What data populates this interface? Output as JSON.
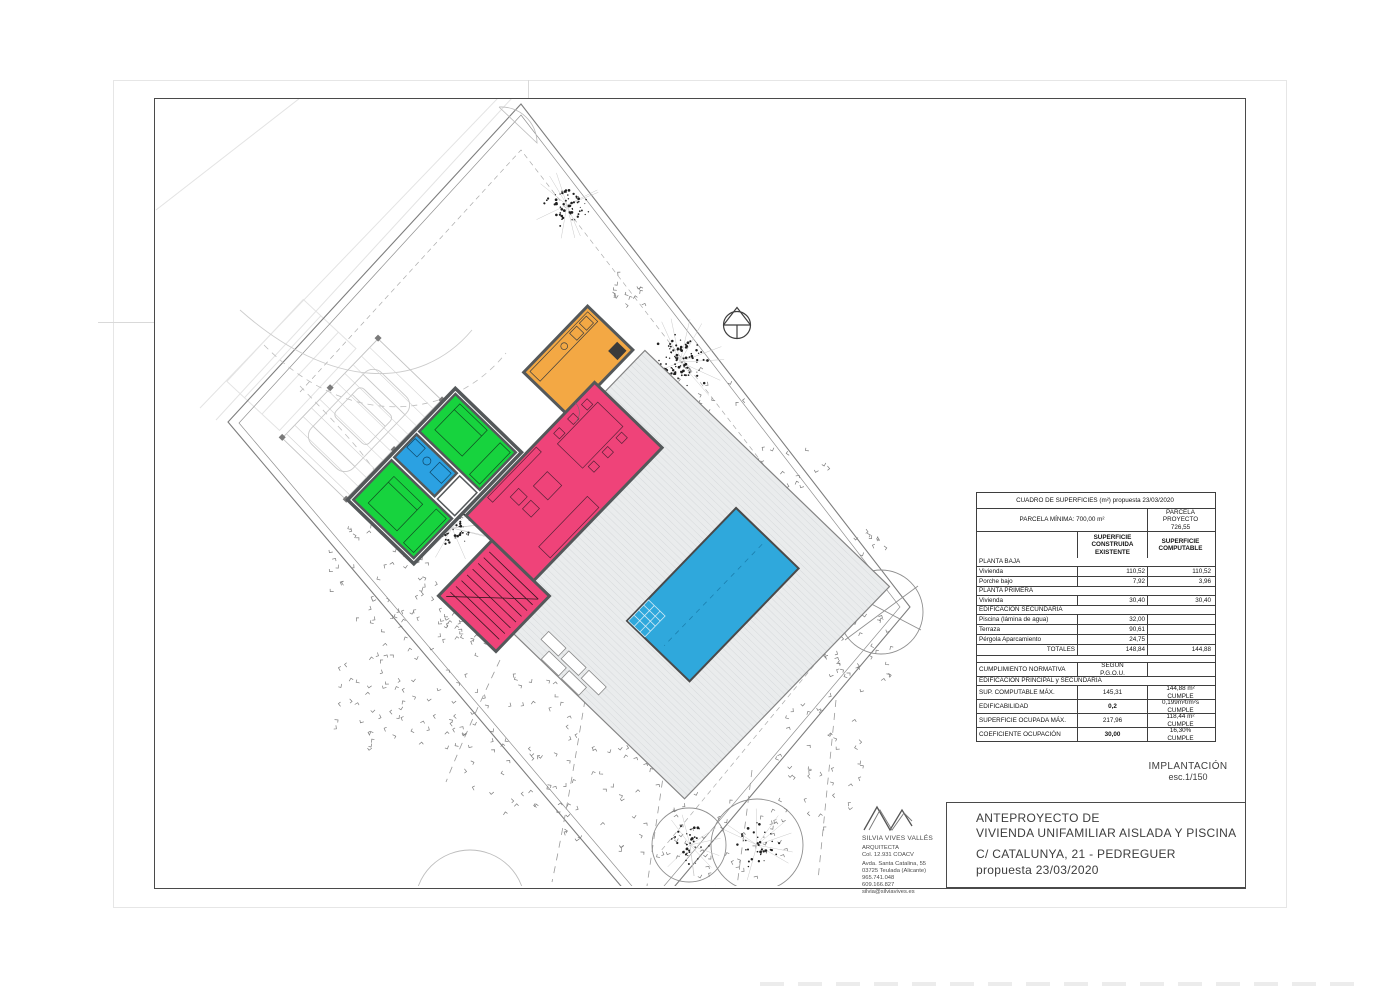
{
  "document": {
    "sheet_label": "IMPLANTACIÓN",
    "sheet_scale": "esc.1/150",
    "title_block": {
      "project_line1": "ANTEPROYECTO DE",
      "project_line2": "VIVIENDA UNIFAMILIAR AISLADA Y PISCINA",
      "address": "C/ CATALUNYA, 21  - PEDREGUER",
      "proposal": "propuesta 23/03/2020"
    },
    "architect": {
      "name": "SILVIA VIVES VALLÉS",
      "title": "ARQUITECTA",
      "license": "Col. 12.931 COACV",
      "address_line1": "Avda. Santa Catalina, 55",
      "address_line2": "03725 Teulada (Alicante)",
      "phone1": "965.741.048",
      "phone2": "609.166.827",
      "email": "silvia@silviavives.es"
    }
  },
  "areas_table": {
    "header": {
      "title": "CUADRO DE SUPERFICIES  (m²) propuesta 23/03/2020",
      "parcela_minima": "PARCELA MÍNIMA: 700,00 m²",
      "parcela_proyecto": [
        "PARCELA",
        "PROYECTO",
        "726,55"
      ],
      "col_existing": [
        "SUPERFICIE",
        "CONSTRUIDA",
        "EXISTENTE"
      ],
      "col_computable": [
        "SUPERFICIE",
        "COMPUTABLE"
      ]
    },
    "rows": [
      {
        "type": "section",
        "label": "PLANTA BAJA"
      },
      {
        "type": "data",
        "label": "Vivienda",
        "existing": "110,52",
        "computable": "110,52"
      },
      {
        "type": "data",
        "label": "Porche bajo",
        "existing": "7,92",
        "computable": "3,96"
      },
      {
        "type": "section",
        "label": "PLANTA PRIMERA"
      },
      {
        "type": "data",
        "label": "Vivienda",
        "existing": "30,40",
        "computable": "30,40"
      },
      {
        "type": "section",
        "label": "EDIFICACIÓN SECUNDARIA"
      },
      {
        "type": "data",
        "label": "Piscina (lámina de agua)",
        "existing": "32,00",
        "computable": ""
      },
      {
        "type": "data",
        "label": "Terraza",
        "existing": "90,61",
        "computable": ""
      },
      {
        "type": "data",
        "label": "Pérgola Aparcamiento",
        "existing": "24,75",
        "computable": ""
      },
      {
        "type": "totals",
        "label": "TOTALES",
        "existing": "148,84",
        "computable": "144,88"
      },
      {
        "type": "spacer",
        "label": ""
      },
      {
        "type": "cumpl",
        "label": "CUMPLIMIENTO NORMATIVA",
        "existing": [
          "SEGUN",
          "P.G.O.U."
        ],
        "computable": ""
      },
      {
        "type": "section",
        "label": "EDIFICACIÓN PRINCIPAL y SECUNDARIA"
      },
      {
        "type": "comp",
        "label": "SUP. COMPUTABLE MÁX.",
        "existing": "145,31",
        "computable": [
          "144,88 m²",
          "CUMPLE"
        ]
      },
      {
        "type": "comp",
        "label": "EDIFICABILIDAD",
        "existing": "0,2",
        "computable": [
          "0,199m²t/m²s",
          "CUMPLE"
        ],
        "bold": true
      },
      {
        "type": "comp",
        "label": "SUPERFICIE OCUPADA MÁX.",
        "existing": "217,96",
        "computable": [
          "118,44 m²",
          "CUMPLE"
        ]
      },
      {
        "type": "comp",
        "label": "COEFICIENTE OCUPACIÓN",
        "existing": "30,00",
        "computable": [
          "16,30%",
          "CUMPLE"
        ],
        "bold": true
      }
    ]
  },
  "plan": {
    "colors": {
      "bedroom_green": "#17d33e",
      "bath_blue": "#2ba1e2",
      "living_pink": "#ef4379",
      "kitchen_orange": "#f3a844",
      "pool_blue": "#2fa8dc",
      "terrace_gray": "#eaeced",
      "wall_dark": "#54585a"
    }
  }
}
